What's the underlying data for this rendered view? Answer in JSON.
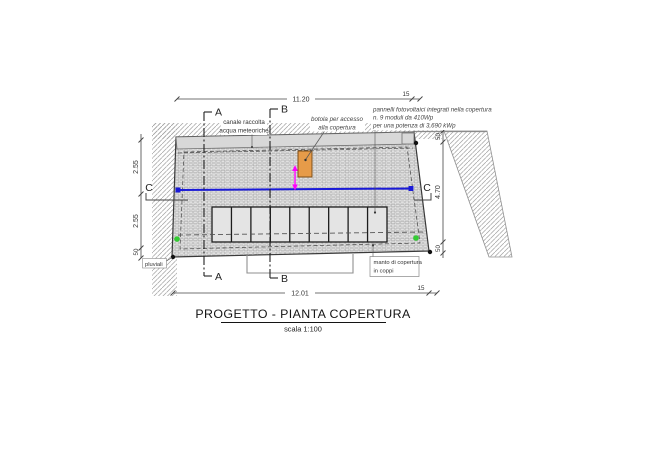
{
  "title": {
    "text": "PROGETTO - PIANTA COPERTURA",
    "scale": "scala 1:100"
  },
  "dimensions": {
    "top_width": "11.20",
    "top_overhang": "15",
    "bottom_width": "12.01",
    "bottom_overhang": "15",
    "left_upper": "2.55",
    "left_lower": "2.55",
    "left_eaves": "50",
    "right_top": "50",
    "right_slope": "4.70",
    "right_bottom": "50"
  },
  "sections": {
    "a": "A",
    "b": "B",
    "c": "C"
  },
  "annotations": {
    "canale_line1": "canale raccolta",
    "canale_line2": "acqua meteoriche",
    "botola_line1": "botola per accesso",
    "botola_line2": "alla copertura",
    "pannelli_line1": "pannelli fotovoltaici integrati nella copertura",
    "pannelli_line2": "n. 9 moduli da 410Wp",
    "pannelli_line3": "per una potenza di 3,690 kWp",
    "pluviali": "pluviali",
    "manto_line1": "manto di copertura",
    "manto_line2": "in coppi"
  },
  "pv_modules": {
    "count": 9,
    "power_each": "410Wp",
    "total_power": "3,690 kWp"
  },
  "colors": {
    "channel_line": "#1a1ad8",
    "marker_magenta": "#ff00ff",
    "access_hatch_fill": "#e69b49",
    "marker_green": "#33cc33"
  }
}
